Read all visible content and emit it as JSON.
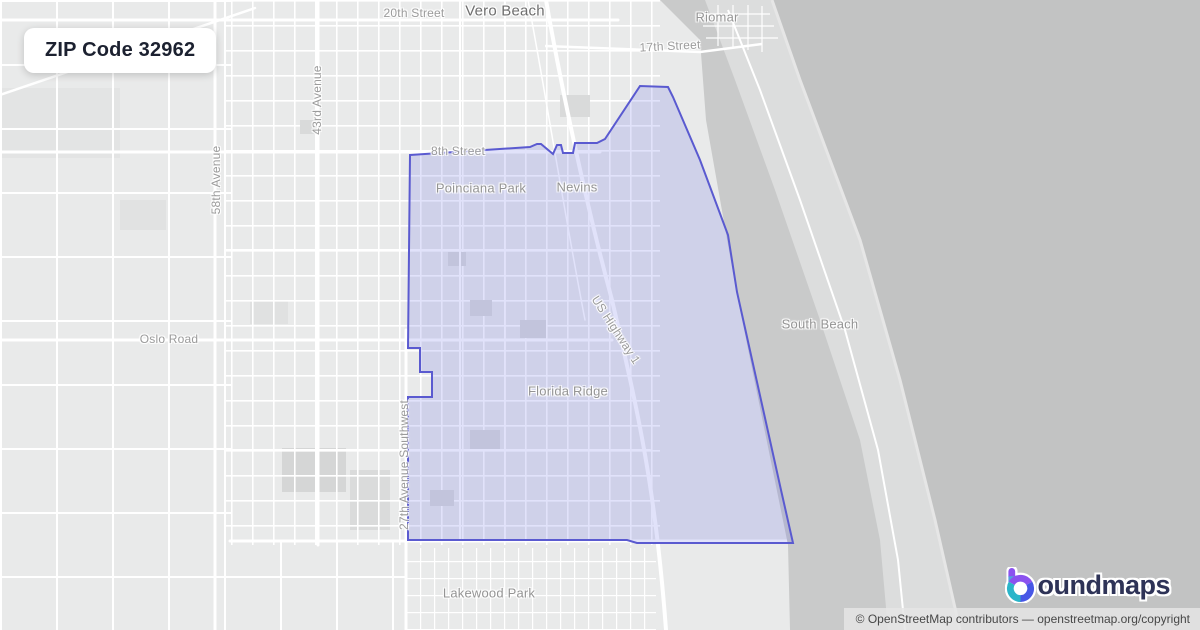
{
  "badge": {
    "title": "ZIP Code 32962"
  },
  "map": {
    "labels": {
      "street_20th": "20th Street",
      "city": "Vero Beach",
      "riomar": "Riomar",
      "street_17th": "17th Street",
      "ave_58th": "58th Avenue",
      "ave_43rd": "43rd Avenue",
      "street_8th": "8th Street",
      "poinciana_park": "Poinciana Park",
      "nevins": "Nevins",
      "oslo_road": "Oslo Road",
      "ave_27th_sw": "27th Avenue Southwest",
      "us_highway_1": "US Highway 1",
      "south_beach": "South Beach",
      "florida_ridge": "Florida Ridge",
      "lakewood_park": "Lakewood Park"
    },
    "boundary": {
      "zip": "32962",
      "stroke_color": "#5a5ad0",
      "fill_color": "rgba(104,108,232,0.20)"
    },
    "colors": {
      "land": "#e9eaea",
      "road": "#ffffff",
      "lagoon": "#c9caca",
      "island": "#dcdddd",
      "ocean": "#c2c3c3"
    }
  },
  "footer": {
    "brand": "boundmaps",
    "brand_rest": "oundmaps",
    "brand_color": "#2e3357",
    "icon_colors": {
      "purple": "#8b52ef",
      "blue": "#4757e6",
      "teal": "#2ab5c9"
    },
    "attribution": "© OpenStreetMap contributors — openstreetmap.org/copyright"
  }
}
